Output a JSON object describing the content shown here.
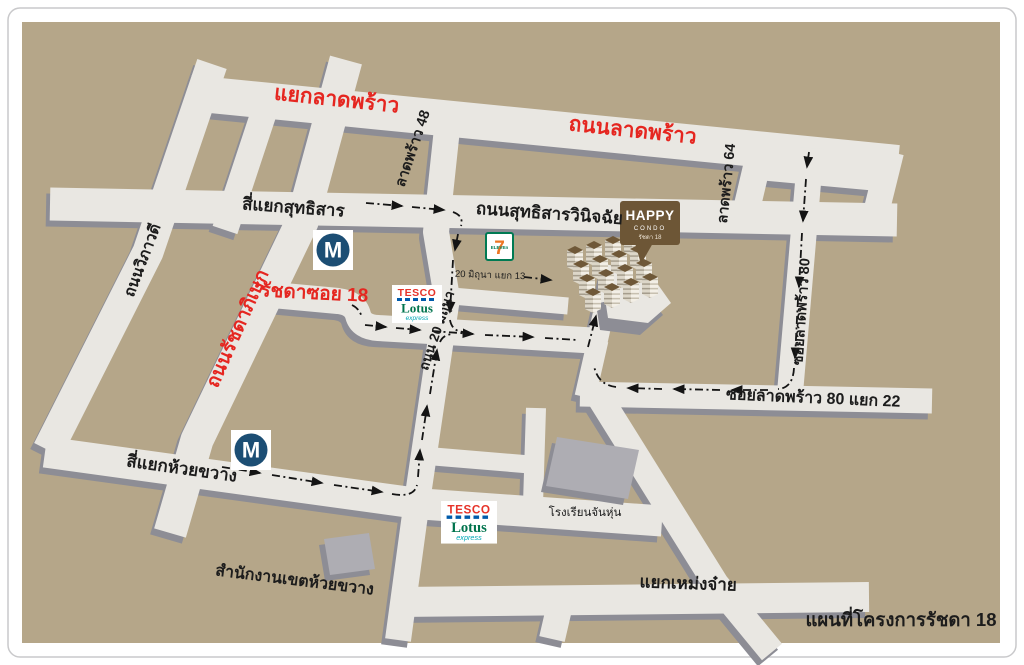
{
  "map": {
    "caption": "แผนที่โครงการรัชดา 18",
    "colors": {
      "land": "#b5a689",
      "road": "#e9e7e2",
      "road_shadow": "#8d8d95",
      "building_gray": "#aeadb3",
      "red_label": "#e52620",
      "black_label": "#1c1c1c",
      "mrt_blue": "#1c4e74",
      "happy_brown": "#6d5636",
      "condo_roof_brown": "#6f5838",
      "tesco_red": "#e63329",
      "tesco_blue": "#005bab",
      "lotus_green": "#00734d",
      "express_teal": "#00a7b5",
      "seven_green": "#007a53",
      "seven_orange": "#ee7623"
    },
    "roads": {
      "yaek_lat_phrao": "แยกลาดพร้าว",
      "thanon_lat_phrao": "ถนนลาดพร้าว",
      "lat_phrao_48": "ลาดพร้าว 48",
      "si_yaek_sutthisan": "สี่แยกสุทธิสาร",
      "thanon_sutthisan_winitchai": "ถนนสุทธิสารวินิจฉัย",
      "lat_phrao_64": "ลาดพร้าว 64",
      "soi_lat_phrao_80": "ซอยลาดพร้าว 80",
      "soi_lat_phrao_80_yaek_22": "ซอยลาดพร้าว 80 แยก 22",
      "thanon_wiphawadi": "ถนนวิภาวดี",
      "thanon_ratchadaphisek": "ถนนรัชดาภิเษก",
      "ratchada_soi_18": "รัชดาซอย 18",
      "thanon_20_mithuna": "ถนน 20 มิถุนา",
      "mithuna_yaek_13": "20 มิถุนา แยก 13",
      "si_yaek_huai_khwang": "สี่แยกห้วยขวาง",
      "yaek_meng_jai": "แยกเหม่งจ๋าย"
    },
    "landmarks": {
      "district_office": "สำนักงานเขตห้วยขวาง",
      "school": "โรงเรียนจันหุ่น",
      "mrt_letter": "M",
      "seven_digit": "7",
      "seven_text": "ELEVEn",
      "tesco": "TESCO",
      "lotus": "Lotus",
      "express": "express"
    },
    "project": {
      "sign_line1": "HAPPY",
      "sign_line2": "CONDO",
      "sign_line3": "รัชดา 18"
    }
  }
}
